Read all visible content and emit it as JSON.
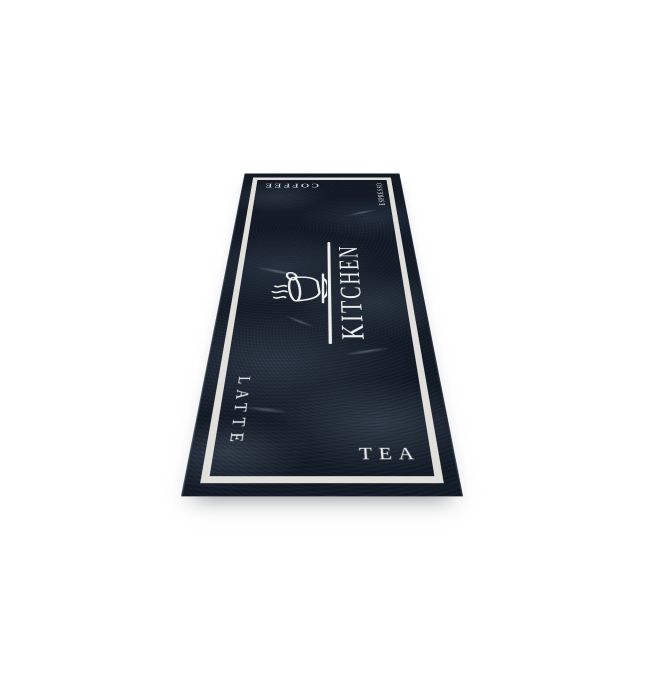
{
  "photo": {
    "background_color": "#ffffff",
    "subject": "kitchen-runner-rug"
  },
  "rug": {
    "labels": {
      "kitchen": "KITCHEN",
      "coffee": "COFFEE",
      "espresso": "ESPRESSO",
      "latte": "LATTE",
      "tea": "TEA"
    },
    "colors": {
      "base": "#131b26",
      "marble_light": "#7e93a6",
      "frame": "#eceae5",
      "text": "#eef0ee"
    },
    "icons": {
      "center": "coffee-cup-with-steam-on-saucer"
    }
  }
}
